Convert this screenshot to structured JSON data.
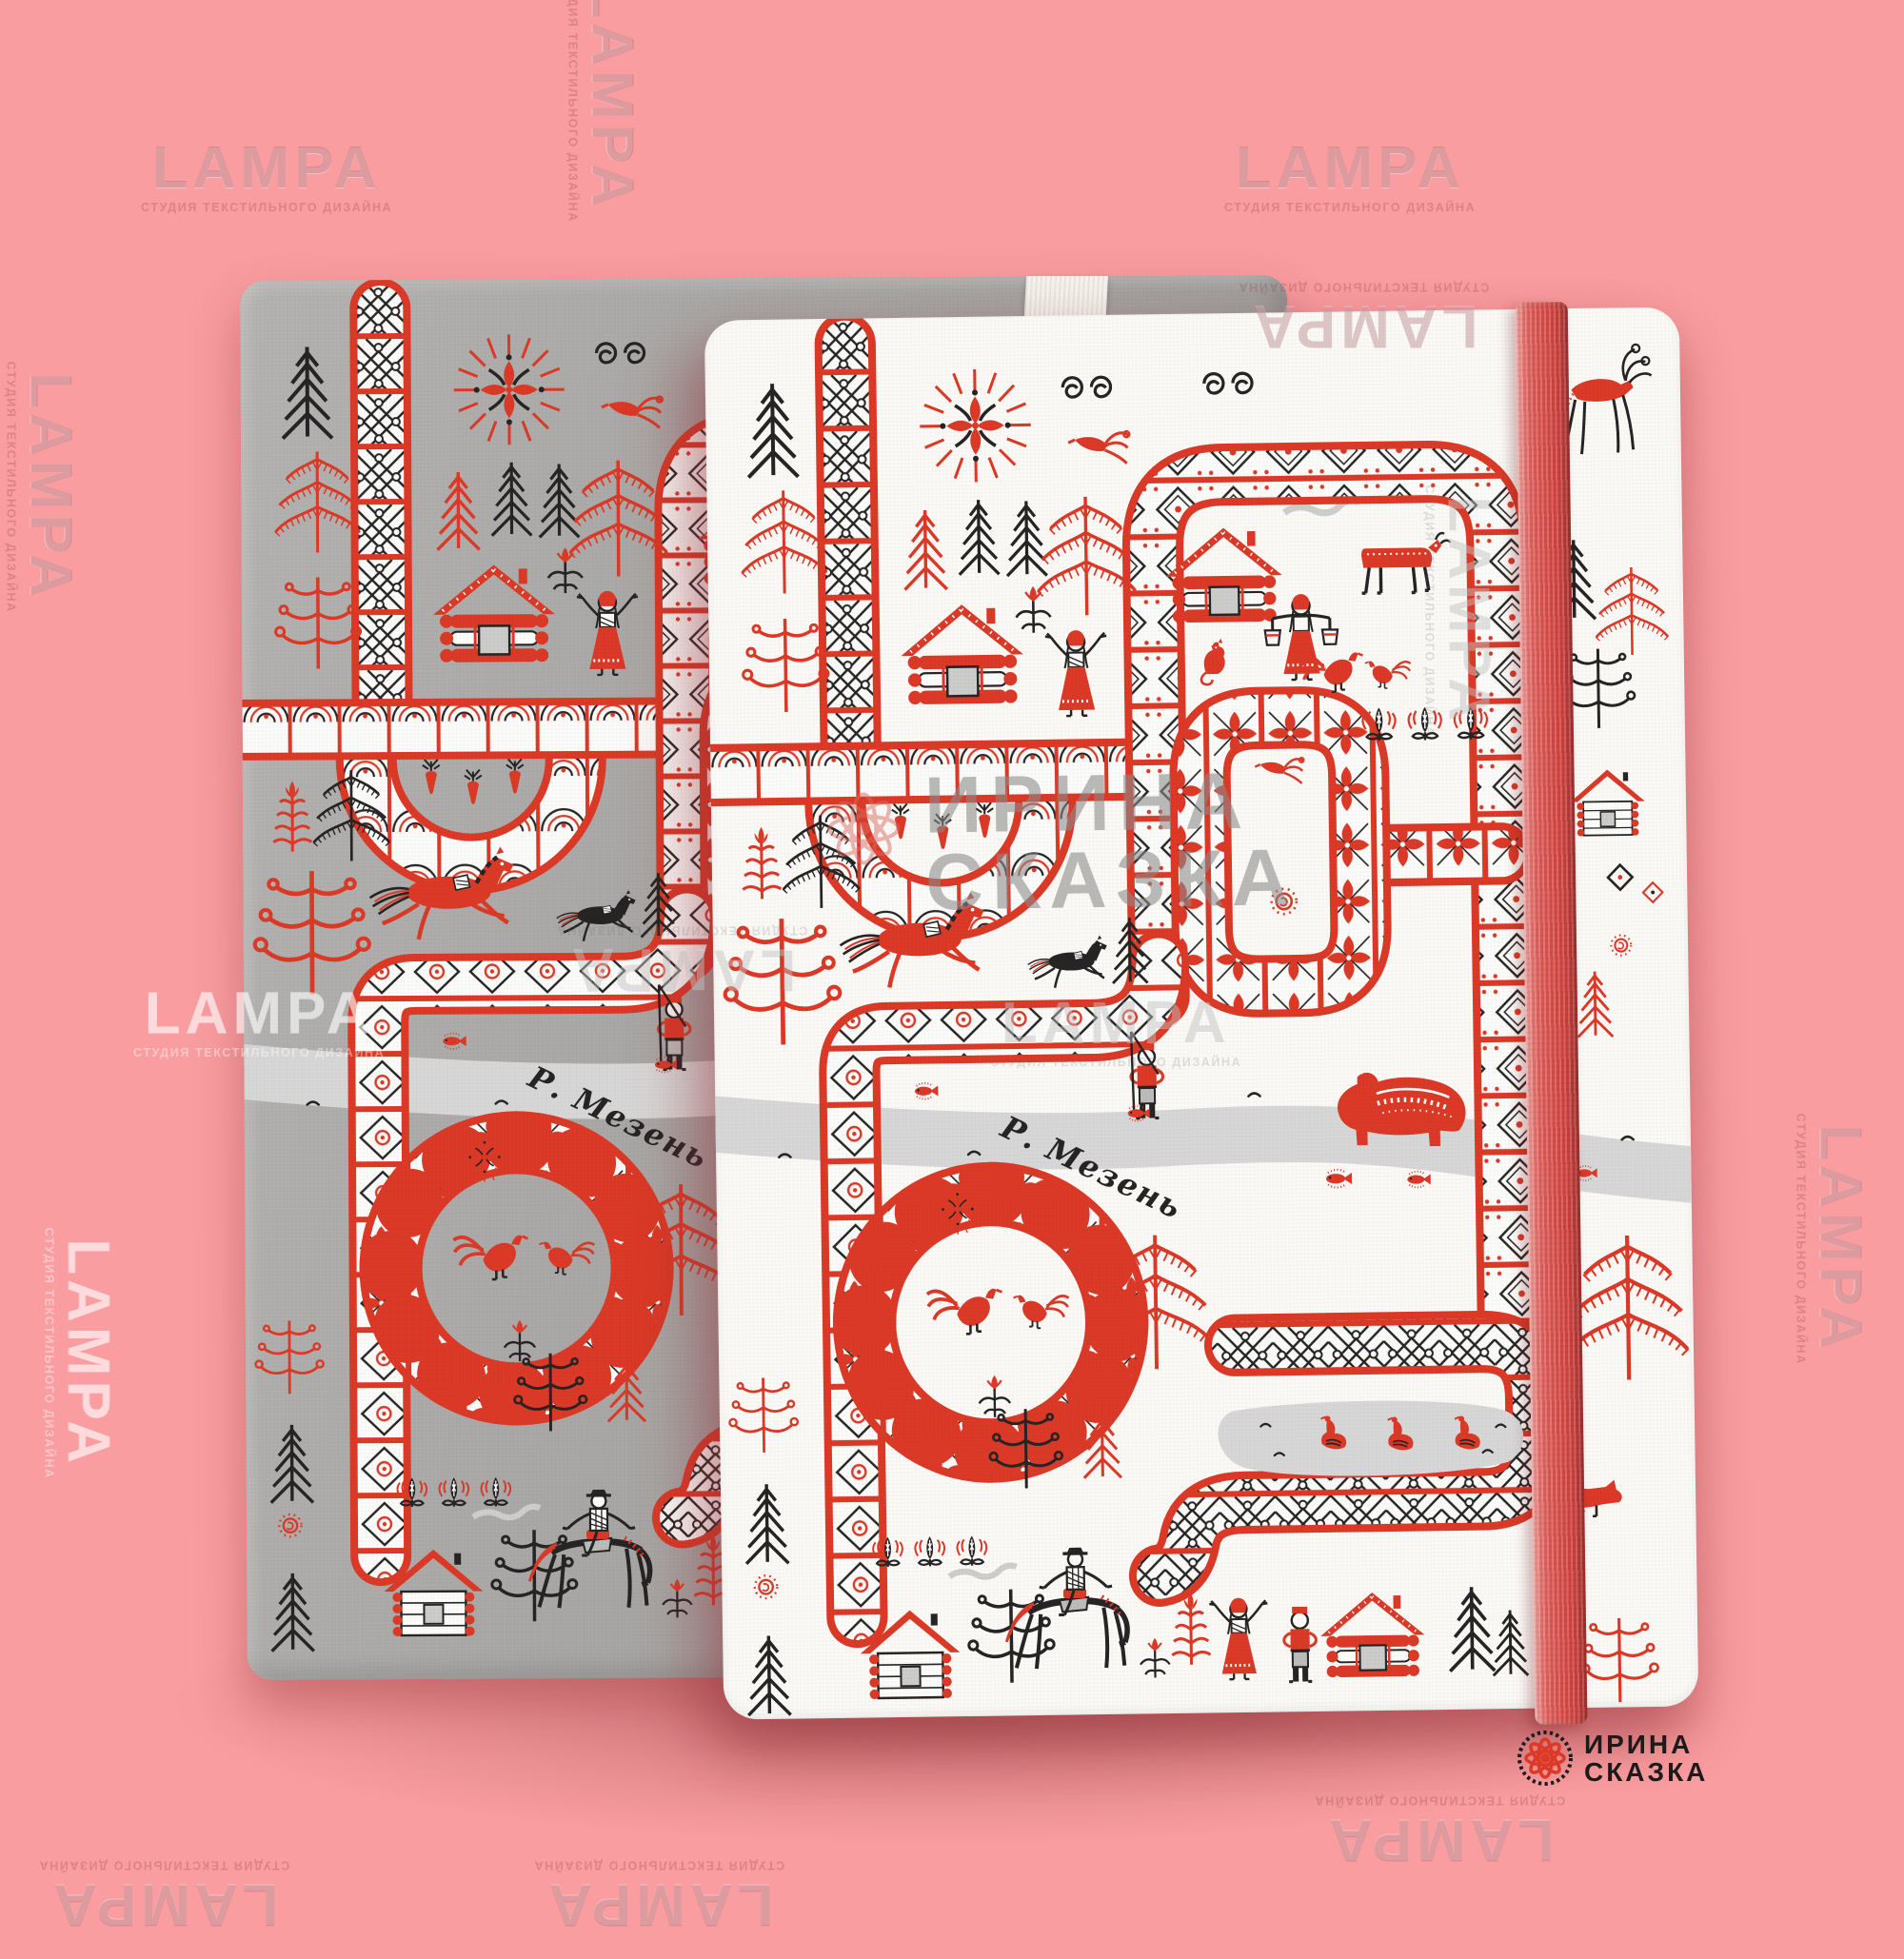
{
  "watermark": {
    "title": "LAMPA",
    "subtitle": "СТУДИЯ ТЕКСТИЛЬНОГО ДИЗАЙНА"
  },
  "brand": {
    "line1": "ИРИНА",
    "line2": "СКАЗКА"
  },
  "scene": {
    "river_label": "Р. Мезень"
  },
  "colors": {
    "bg": "#f99da0",
    "red": "#dc3a27",
    "black": "#262424",
    "cover-white": "#fcfbf8",
    "cover-gray": "#aaa9a7",
    "river": "#d8d8d8",
    "elastic": "#d84744",
    "logo-text": "#1c1b1a"
  },
  "products": {
    "back_notebook": "gray hardcover notebook with folk print",
    "front_notebook": "white hardcover notebook with folk print and red elastic band"
  },
  "pattern_motifs": [
    "fir-tree",
    "fringed-fir",
    "curly-fir",
    "sun-rosette",
    "double-spiral",
    "log-cabin",
    "white-cabin",
    "woman",
    "woman-with-buckets",
    "man",
    "fisherman",
    "horseman",
    "red-horse",
    "black-horse",
    "red-bear",
    "red-deer",
    "red-fox",
    "red-cat",
    "red-cow",
    "rooster",
    "hen",
    "fire-bird",
    "swan",
    "fish",
    "flying-bird",
    "flower",
    "red-plant",
    "sprout",
    "carrot",
    "smoke",
    "sun-swirl",
    "ornamental-band",
    "bird-medallion-ring",
    "river",
    "pond"
  ]
}
